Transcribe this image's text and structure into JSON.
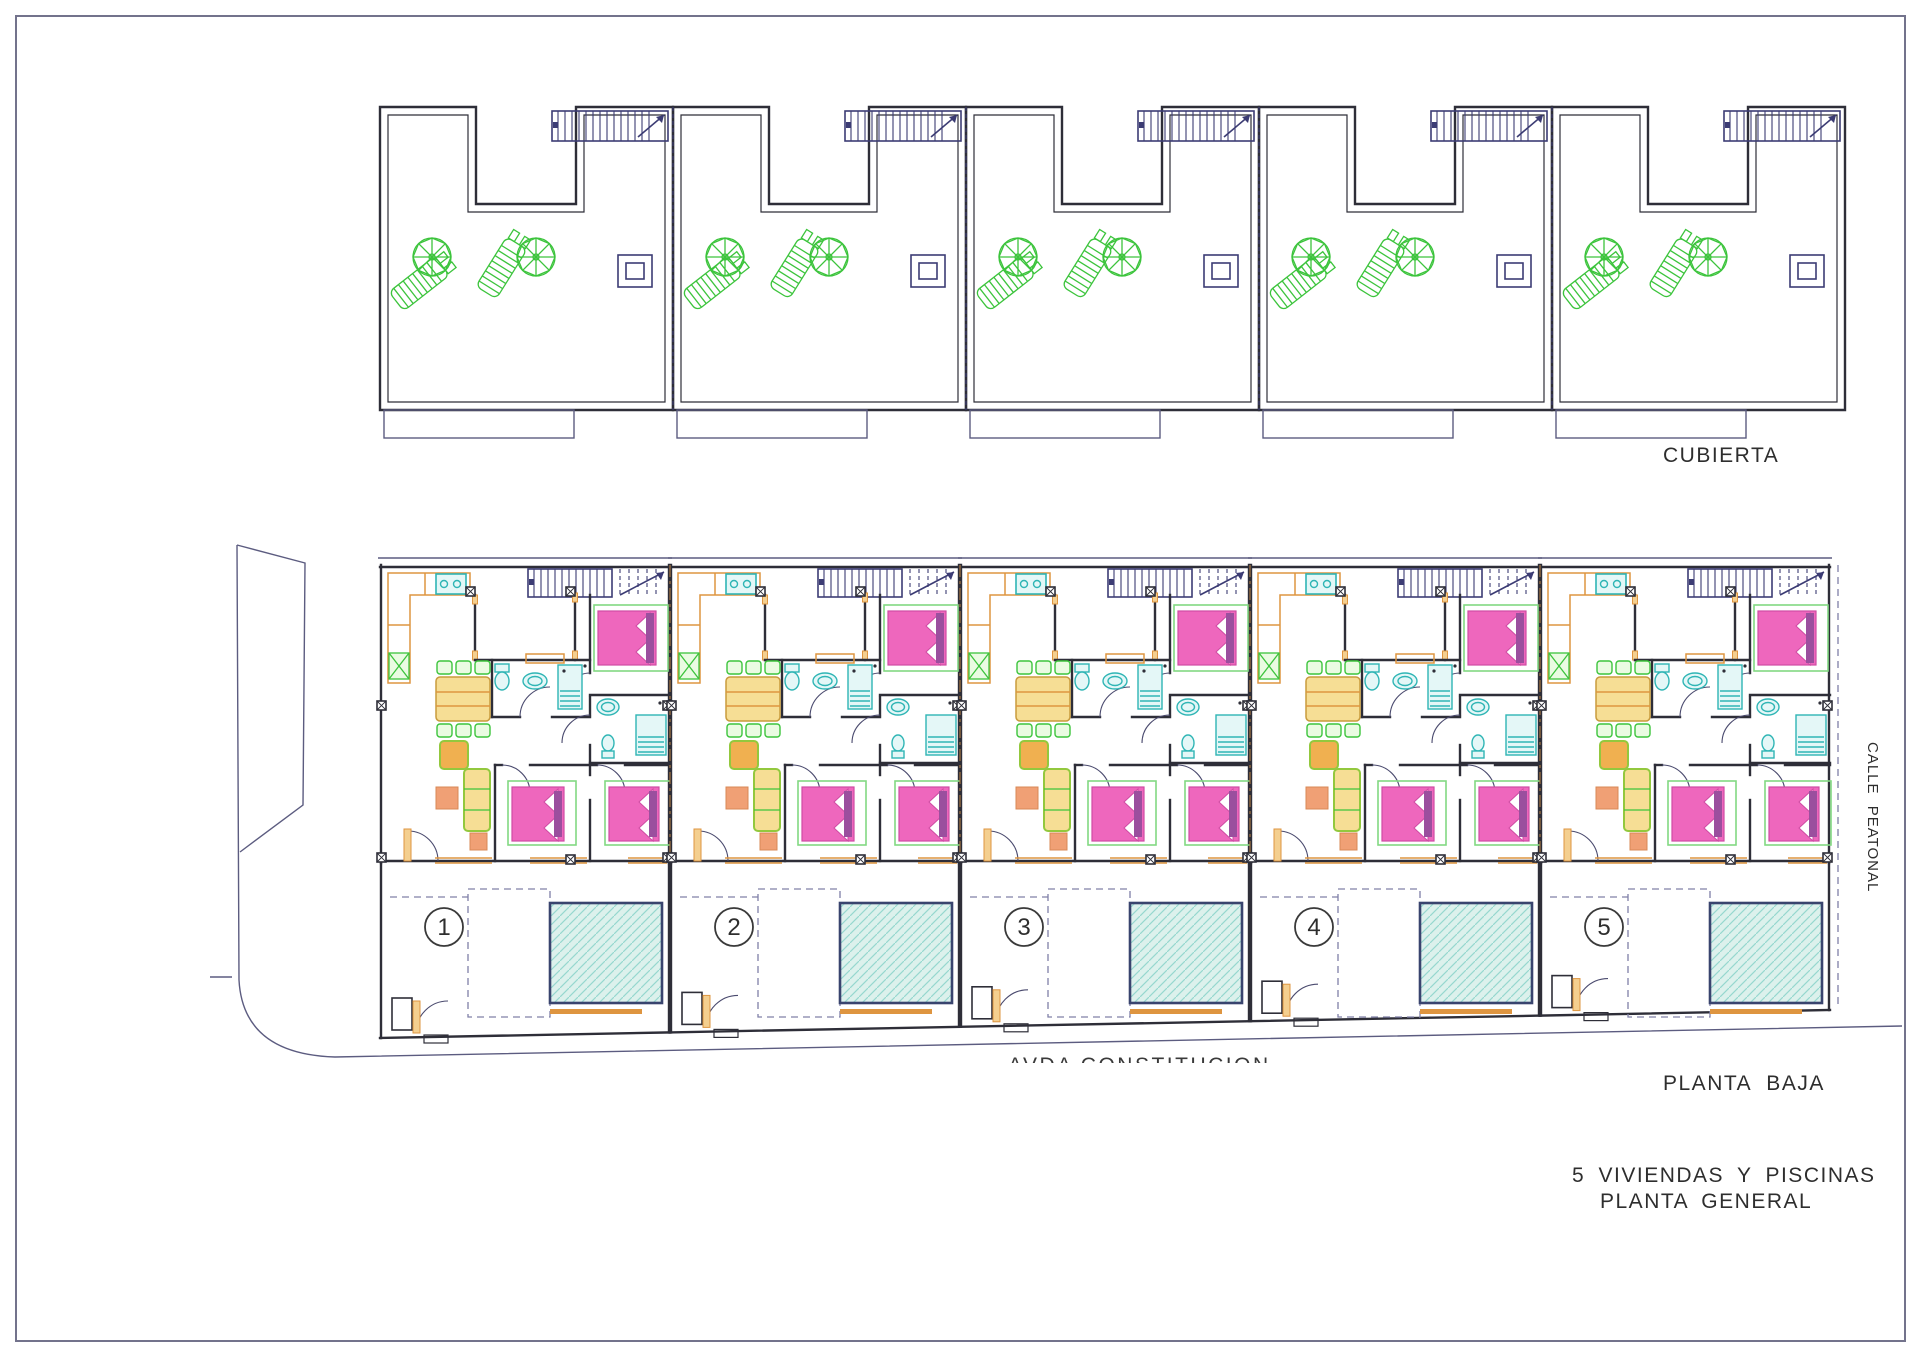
{
  "titles": {
    "roof_label": "CUBIERTA",
    "ground_label": "PLANTA BAJA",
    "project_line1": "5 VIVIENDAS Y PISCINAS",
    "project_line2": "PLANTA GENERAL",
    "street_right": "CALLE PEATONAL",
    "street_bottom": "AVDA CONSTITUCION"
  },
  "plan": {
    "unit_count": 5,
    "unit_numbers": [
      "1",
      "2",
      "3",
      "4",
      "5"
    ]
  },
  "palette": {
    "wall": "#2e2e38",
    "navy": "#3c3c74",
    "slate": "#8080a8",
    "street": "#5c5c80",
    "dashdot": "#b07a40",
    "arcc": "#4a4a6e",
    "orange": "#de9540",
    "orange_mid": "#f0b050",
    "orange_light": "#f4cf8f",
    "green": "#3cc43c",
    "green_light": "#eafbe2",
    "frame_green": "#82d882",
    "pink": "#ee67bd",
    "pink_dark": "#cf4ba3",
    "purple": "#9b4f9e",
    "cyan": "#2fb5b5",
    "cyan_light": "#e4f7f7",
    "pool_fill": "#dcf1ec",
    "pool_hatch": "#96d7cf",
    "pool_border": "#39446e",
    "yellow": "#f6de95",
    "yellow_dark": "#c89b3c",
    "sofa_green": "#93c83e",
    "salmon": "#f0a075",
    "salmon_dk": "#d88856",
    "text": "#2e2e2e",
    "border": "#73738c"
  }
}
